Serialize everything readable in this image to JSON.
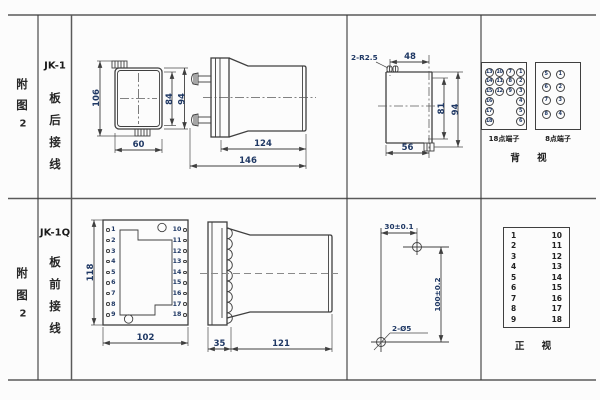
{
  "colors": {
    "line": "#3f3f3f",
    "grid_line": "#5a5a5a",
    "dimension_text": "#1f3864",
    "label_text": "#262626",
    "background": "#fcfcfc"
  },
  "rows": [
    {
      "figure": [
        "附",
        "图",
        "2"
      ],
      "model": "JK-1",
      "wiring": [
        "板",
        "后",
        "接",
        "线"
      ]
    },
    {
      "figure": [
        "附",
        "图",
        "2"
      ],
      "model": "JK-1Q",
      "wiring": [
        "板",
        "前",
        "接",
        "线"
      ]
    }
  ],
  "rear_view": {
    "dim_height": "106",
    "dim_inner": "84",
    "dim_outer": "94",
    "dim_width": "60"
  },
  "side_view_rear": {
    "dim_body": "124",
    "dim_total": "146"
  },
  "cutout": {
    "callout": "2-R2.5",
    "dim_top": "48",
    "dim_inner_h": "81",
    "dim_outer_h": "94",
    "dim_width": "56"
  },
  "terminals_18": {
    "label": "18点端子",
    "grid": [
      [
        "13",
        "10",
        "7",
        "1"
      ],
      [
        "14",
        "11",
        "8",
        "2"
      ],
      [
        "15",
        "12",
        "9",
        "3"
      ],
      [
        "16",
        null,
        null,
        "4"
      ],
      [
        "17",
        null,
        null,
        "5"
      ],
      [
        "18",
        null,
        null,
        "6"
      ]
    ]
  },
  "terminals_8": {
    "label": "8点端子",
    "grid": [
      [
        "5",
        "1"
      ],
      [
        "6",
        "2"
      ],
      [
        "7",
        "3"
      ],
      [
        "8",
        "4"
      ]
    ]
  },
  "back_view_label": "背 视",
  "front_view": {
    "dim_height": "118",
    "dim_width": "102",
    "left_terminals": [
      "1",
      "2",
      "3",
      "4",
      "5",
      "6",
      "7",
      "8",
      "9"
    ],
    "right_terminals": [
      "10",
      "11",
      "12",
      "13",
      "14",
      "15",
      "16",
      "17",
      "18"
    ]
  },
  "side_view_front": {
    "dim_flange": "35",
    "dim_body": "121"
  },
  "drill_plan": {
    "dim_horizontal": "30±0.1",
    "dim_vertical": "100±0.2",
    "callout": "2-Ø5"
  },
  "front_table": {
    "left": [
      "1",
      "2",
      "3",
      "4",
      "5",
      "6",
      "7",
      "8",
      "9"
    ],
    "right": [
      "10",
      "11",
      "12",
      "13",
      "14",
      "15",
      "16",
      "17",
      "18"
    ],
    "label": "正 视"
  }
}
